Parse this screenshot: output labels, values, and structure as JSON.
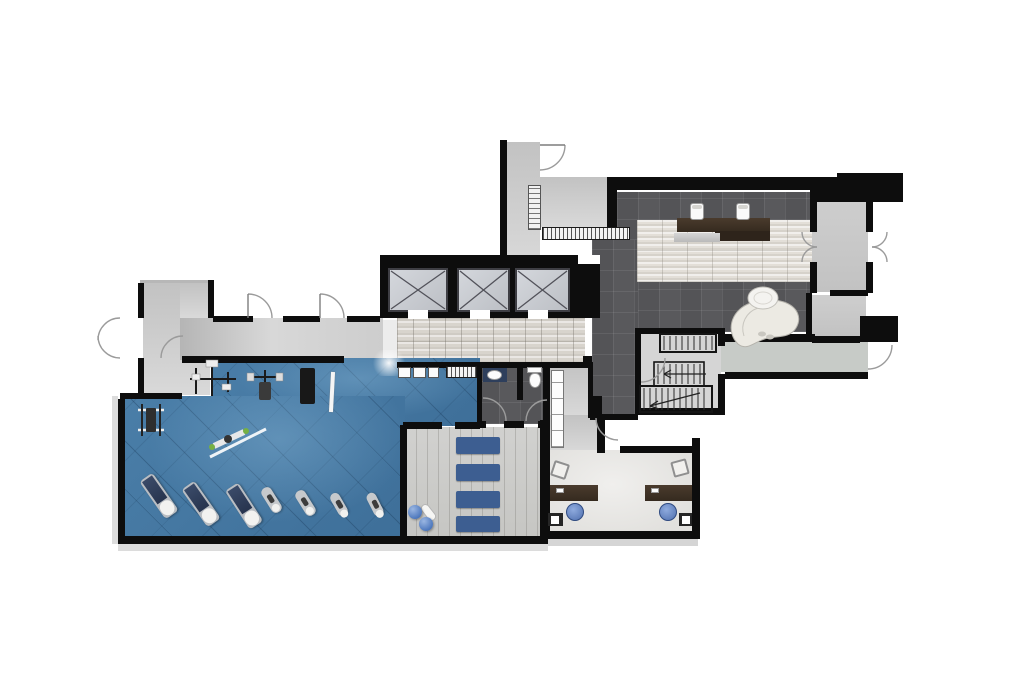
{
  "document": {
    "kind": "rendered architectural floor plan",
    "view": "top-down color presentation plan",
    "subject": "fitness club / gym level with lobby, elevators, offices and studio"
  },
  "colors": {
    "wall": "#0d0d0d",
    "gym_floor": "#4a7ea8",
    "marble": "#d8d4cd",
    "reception_marble": "#e3dfd8",
    "lounge_tile": "#59595c",
    "wood": "#c6c6c3",
    "office": "#e2e1de",
    "stair": "#d5d5d5",
    "vestibule": "#c2c2c2",
    "arm": "#c7cbc7",
    "desk": "#352a1f",
    "mat": "#3d5e91",
    "chair": "#4f6fae",
    "ball": "#2f5fae"
  },
  "rooms": [
    {
      "id": "gym",
      "label": "fitness area with blue diagonal-tile floor"
    },
    {
      "id": "entry-west",
      "label": "west entry vestibule with double doors"
    },
    {
      "id": "corridor",
      "label": "corridor along gym"
    },
    {
      "id": "elevator-bank",
      "label": "three elevator shafts"
    },
    {
      "id": "elevator-lobby",
      "label": "marble elevator lobby"
    },
    {
      "id": "lounge",
      "label": "reception lounge with dark tile"
    },
    {
      "id": "reception",
      "label": "reception desk zone on marble band"
    },
    {
      "id": "entry-east",
      "label": "east entry vestibule with double doors"
    },
    {
      "id": "stairwell",
      "label": "switchback stair"
    },
    {
      "id": "restroom",
      "label": "restroom with sink and toilet"
    },
    {
      "id": "studio",
      "label": "exercise studio with four mats"
    },
    {
      "id": "offices",
      "label": "back office with two workstations"
    }
  ],
  "furniture_inventory": {
    "elevators": 3,
    "treadmills": 3,
    "cardio_machines": 4,
    "strength_stations": 4,
    "weight_bench": 1,
    "exercise_mats": 4,
    "exercise_balls": 2,
    "foam_roller": 1,
    "reception_desk": 1,
    "reception_chairs": 2,
    "chaise_lounge": 1,
    "side_table": 1,
    "office_desks": 2,
    "task_chairs": 2,
    "guest_chairs": 2,
    "cabinets": 2,
    "sink": 1,
    "toilet": 1,
    "stair_flights": 3,
    "door_swings": 14
  }
}
